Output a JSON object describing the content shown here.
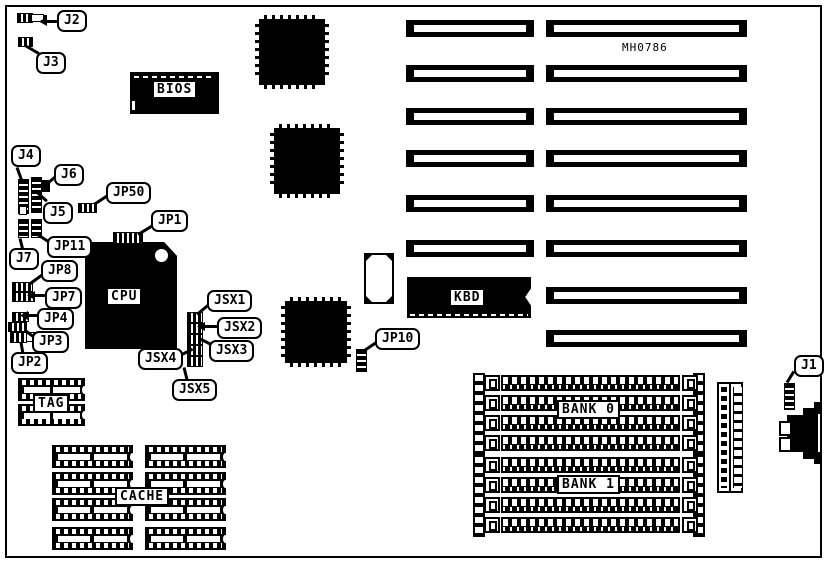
{
  "board": {
    "part_number": "MH0786"
  },
  "labels": {
    "j1": "J1",
    "j2": "J2",
    "j3": "J3",
    "j4": "J4",
    "j5": "J5",
    "j6": "J6",
    "j7": "J7",
    "jp1": "JP1",
    "jp2": "JP2",
    "jp3": "JP3",
    "jp4": "JP4",
    "jp7": "JP7",
    "jp8": "JP8",
    "jp10": "JP10",
    "jp11": "JP11",
    "jp50": "JP50",
    "jsx1": "JSX1",
    "jsx2": "JSX2",
    "jsx3": "JSX3",
    "jsx4": "JSX4",
    "jsx5": "JSX5"
  },
  "chips": {
    "bios": "BIOS",
    "cpu": "CPU",
    "kbd": "KBD",
    "tag": "TAG",
    "cache": "CACHE",
    "bank0": "BANK 0",
    "bank1": "BANK 1"
  },
  "colors": {
    "ink": "#000000",
    "paper": "#ffffff"
  }
}
